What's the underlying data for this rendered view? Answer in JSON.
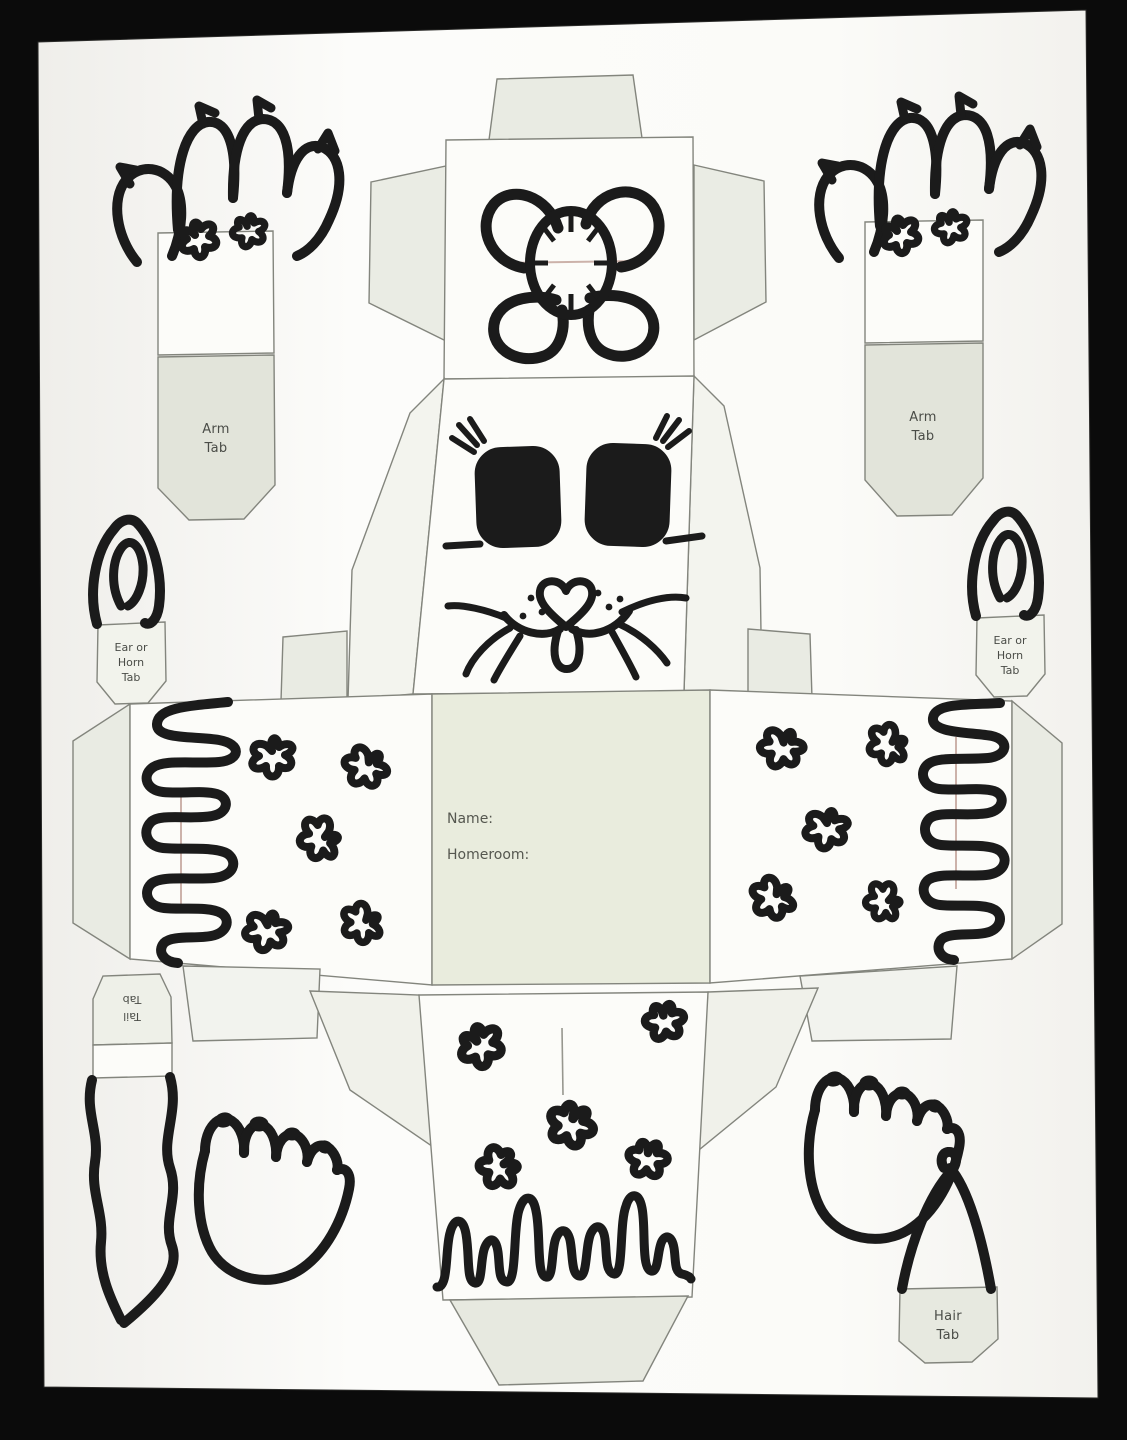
{
  "photo": {
    "background_color": "#0b0b0b",
    "paper_color": "#fbfbf8",
    "panel_tint": "#e9ebe2",
    "marker_color": "#1b1b1b",
    "fold_line_color": "#a5766a"
  },
  "template": {
    "tabs": {
      "arm_left": {
        "line1": "Arm",
        "line2": "Tab"
      },
      "arm_right": {
        "line1": "Arm",
        "line2": "Tab"
      },
      "ear_left": {
        "line1": "Ear or",
        "line2": "Horn",
        "line3": "Tab"
      },
      "ear_right": {
        "line1": "Ear or",
        "line2": "Horn",
        "line3": "Tab"
      },
      "tail": {
        "line1": "Tail",
        "line2": "Tab"
      },
      "hair": {
        "line1": "Hair",
        "line2": "Tab"
      }
    },
    "fields": {
      "name_label": "Name:",
      "homeroom_label": "Homeroom:"
    }
  }
}
